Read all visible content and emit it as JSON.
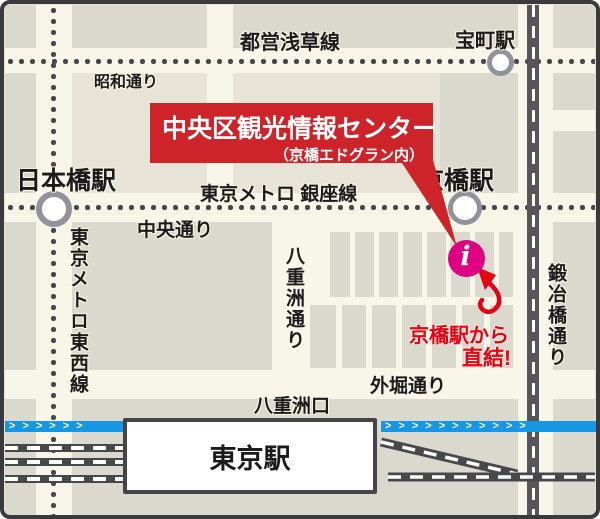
{
  "labels": {
    "asakusa_line": "都営浅草線",
    "takaracho_station": "宝町駅",
    "showa_dori": "昭和通り",
    "banner_title": "中央区観光情報センター",
    "banner_subtitle": "（京橋エドグラン内）",
    "nihonbashi_station": "日本橋駅",
    "ginza_line": "東京メトロ 銀座線",
    "kyobashi_station": "京橋駅",
    "chuo_dori": "中央通り",
    "tozai_line": "東京メトロ東西線",
    "yaesu_dori": "八重洲通り",
    "kajibashi_dori": "鍛冶橋通り",
    "info_glyph": "i",
    "direct_note_line1": "京橋駅から",
    "direct_note_line2": "直結!",
    "sotobori_dori": "外堀通り",
    "yaesu_exit": "八重洲口",
    "tokyo_station": "東京駅",
    "chevrons_left": ">>>>>>",
    "chevrons_right": ">>>>>>>>>>>"
  },
  "colors": {
    "banner_red": "#CF232A",
    "note_red": "#E60012",
    "info_marker_pink": "#DE0080",
    "shinkansen_blue": "#1697E3",
    "street_cream": "#F8F5E9",
    "block_gray": "#DBD8CE",
    "base_beige": "#E7E3D7",
    "subway_dot_gray": "#48484B",
    "station_ring_gray": "#92929A"
  }
}
